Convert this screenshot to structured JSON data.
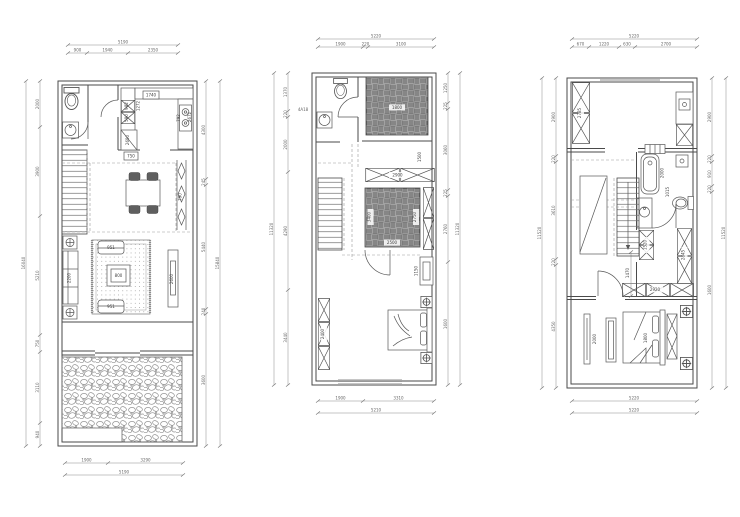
{
  "style": {
    "background": "#ffffff",
    "wall_color": "#4a4a4a",
    "dim_color": "#8c8c8c",
    "pattern_gray": "#bdbdbd"
  },
  "p1": {
    "dims": {
      "top_total": "5190",
      "top_segs": [
        "900",
        "1940",
        "2350"
      ],
      "bottom_segs": [
        "1900",
        "3290"
      ],
      "bottom_total": "5190",
      "left_segs": [
        "2000",
        "3900",
        "5210",
        "750",
        "3110",
        "940"
      ],
      "left_total": "16040",
      "right_segs": [
        "4300",
        "245",
        "5440",
        "240",
        "3600"
      ],
      "right_total": "15840"
    },
    "rooms": {
      "counter_box": "1740",
      "depth": "1272",
      "cab_a": "982",
      "cab_b": "590",
      "fridge": "2690",
      "stove": "792",
      "kitchen_w": "2672",
      "pass_box": "750",
      "screen": "790",
      "armchair_a": "951",
      "table": "800",
      "armchair_b": "951",
      "sofa": "2200",
      "tv": "2600"
    }
  },
  "p2": {
    "dims": {
      "top_total": "5220",
      "top_segs": [
        "1900",
        "220",
        "3100"
      ],
      "bottom_segs": [
        "1900",
        "3310"
      ],
      "bottom_total": "5210",
      "left_segs": [
        "1370",
        "220",
        "2000",
        "4290",
        "3440"
      ],
      "left_total": "11320",
      "right_segs": [
        "1250",
        "225",
        "3060",
        "225",
        "2760",
        "1600"
      ],
      "right_total": "11320"
    },
    "rooms": {
      "bed1": "1800",
      "shelf": "1500",
      "cabinet": "2900",
      "bed2_len": "3400",
      "bed2": "2500",
      "wardrobe_r": "2750",
      "chest": "1150",
      "wardrobe_l": "2400"
    },
    "note": "4A18"
  },
  "p3": {
    "dims": {
      "top_total": "5220",
      "top_segs": [
        "670",
        "1220",
        "630",
        "2700"
      ],
      "bottom_total_a": "5220",
      "bottom_total_b": "5220",
      "left_segs": [
        "2900",
        "220",
        "3610",
        "220",
        "4350"
      ],
      "left_total": "11520",
      "right_segs": [
        "2900",
        "220",
        "910",
        "220",
        "1600"
      ],
      "right_total": "11520"
    },
    "rooms": {
      "wardrobe_top": "2785",
      "bathtub": "2000",
      "bath_side": "1015",
      "cabinet": "1520",
      "wardrobe_r": "2845",
      "sideboard": "2920",
      "hall": "1470",
      "tv": "2000",
      "bed": "1800"
    }
  }
}
